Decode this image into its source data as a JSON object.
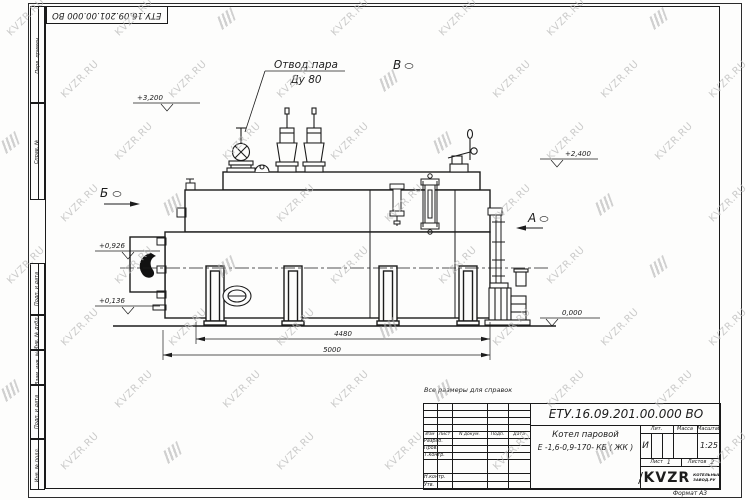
{
  "watermark": {
    "text": "KVZR.RU"
  },
  "sheet": {
    "corner_doc_number": "ЕТУ.16.09.201.00.000  ВО",
    "side_stamps": [
      {
        "label": "Перв. примен."
      },
      {
        "label": "Справ. №"
      },
      {
        "label": "Подп. и дата"
      },
      {
        "label": "Инв. № дубл."
      },
      {
        "label": "Взам. инв. №"
      },
      {
        "label": "Подп. и дата"
      },
      {
        "label": "Инв. № подл."
      }
    ]
  },
  "drawing": {
    "callout_line1": "Отвод пара",
    "callout_line2": "Ду 80",
    "view_a": "А",
    "view_b": "Б",
    "view_v": "В",
    "elev_3200": "+3,200",
    "elev_2400": "+2,400",
    "elev_0926": "+0,926",
    "elev_0136": "+0,136",
    "elev_0000": "0,000",
    "dim_4480": "4480",
    "dim_5000": "5000"
  },
  "note": "Все размеры для справок",
  "title_block": {
    "doc_number": "ЕТУ.16.09.201.00.000  ВО",
    "product_name_line1": "Котел паровой",
    "product_name_line2": "Е -1,6-0,9-170- КБ ( ЖК )",
    "col_izm": "Изм",
    "col_list": "Лист",
    "col_ndoc": "N докум.",
    "col_podp": "Подп.",
    "col_data": "Дата",
    "row_razrab": "Разраб.",
    "row_prov": "Пров.",
    "row_tkontr": "Т.контр.",
    "row_nkontr": "Н.контр.",
    "row_utv": "Утв.",
    "lit_label": "Лит.",
    "lit_value": "И",
    "mass_label": "Масса",
    "scale_label": "Масштаб",
    "scale_value": "1:25",
    "sheet_label": "Лист",
    "sheet_value": "1",
    "sheets_label": "Листов",
    "sheets_value": "2",
    "logo_text": "KVZR",
    "logo_sub1": "КОТЕЛЬНЫЙ",
    "logo_sub2": "ЗАВОД.РУ",
    "format_label": "Формат А3"
  }
}
